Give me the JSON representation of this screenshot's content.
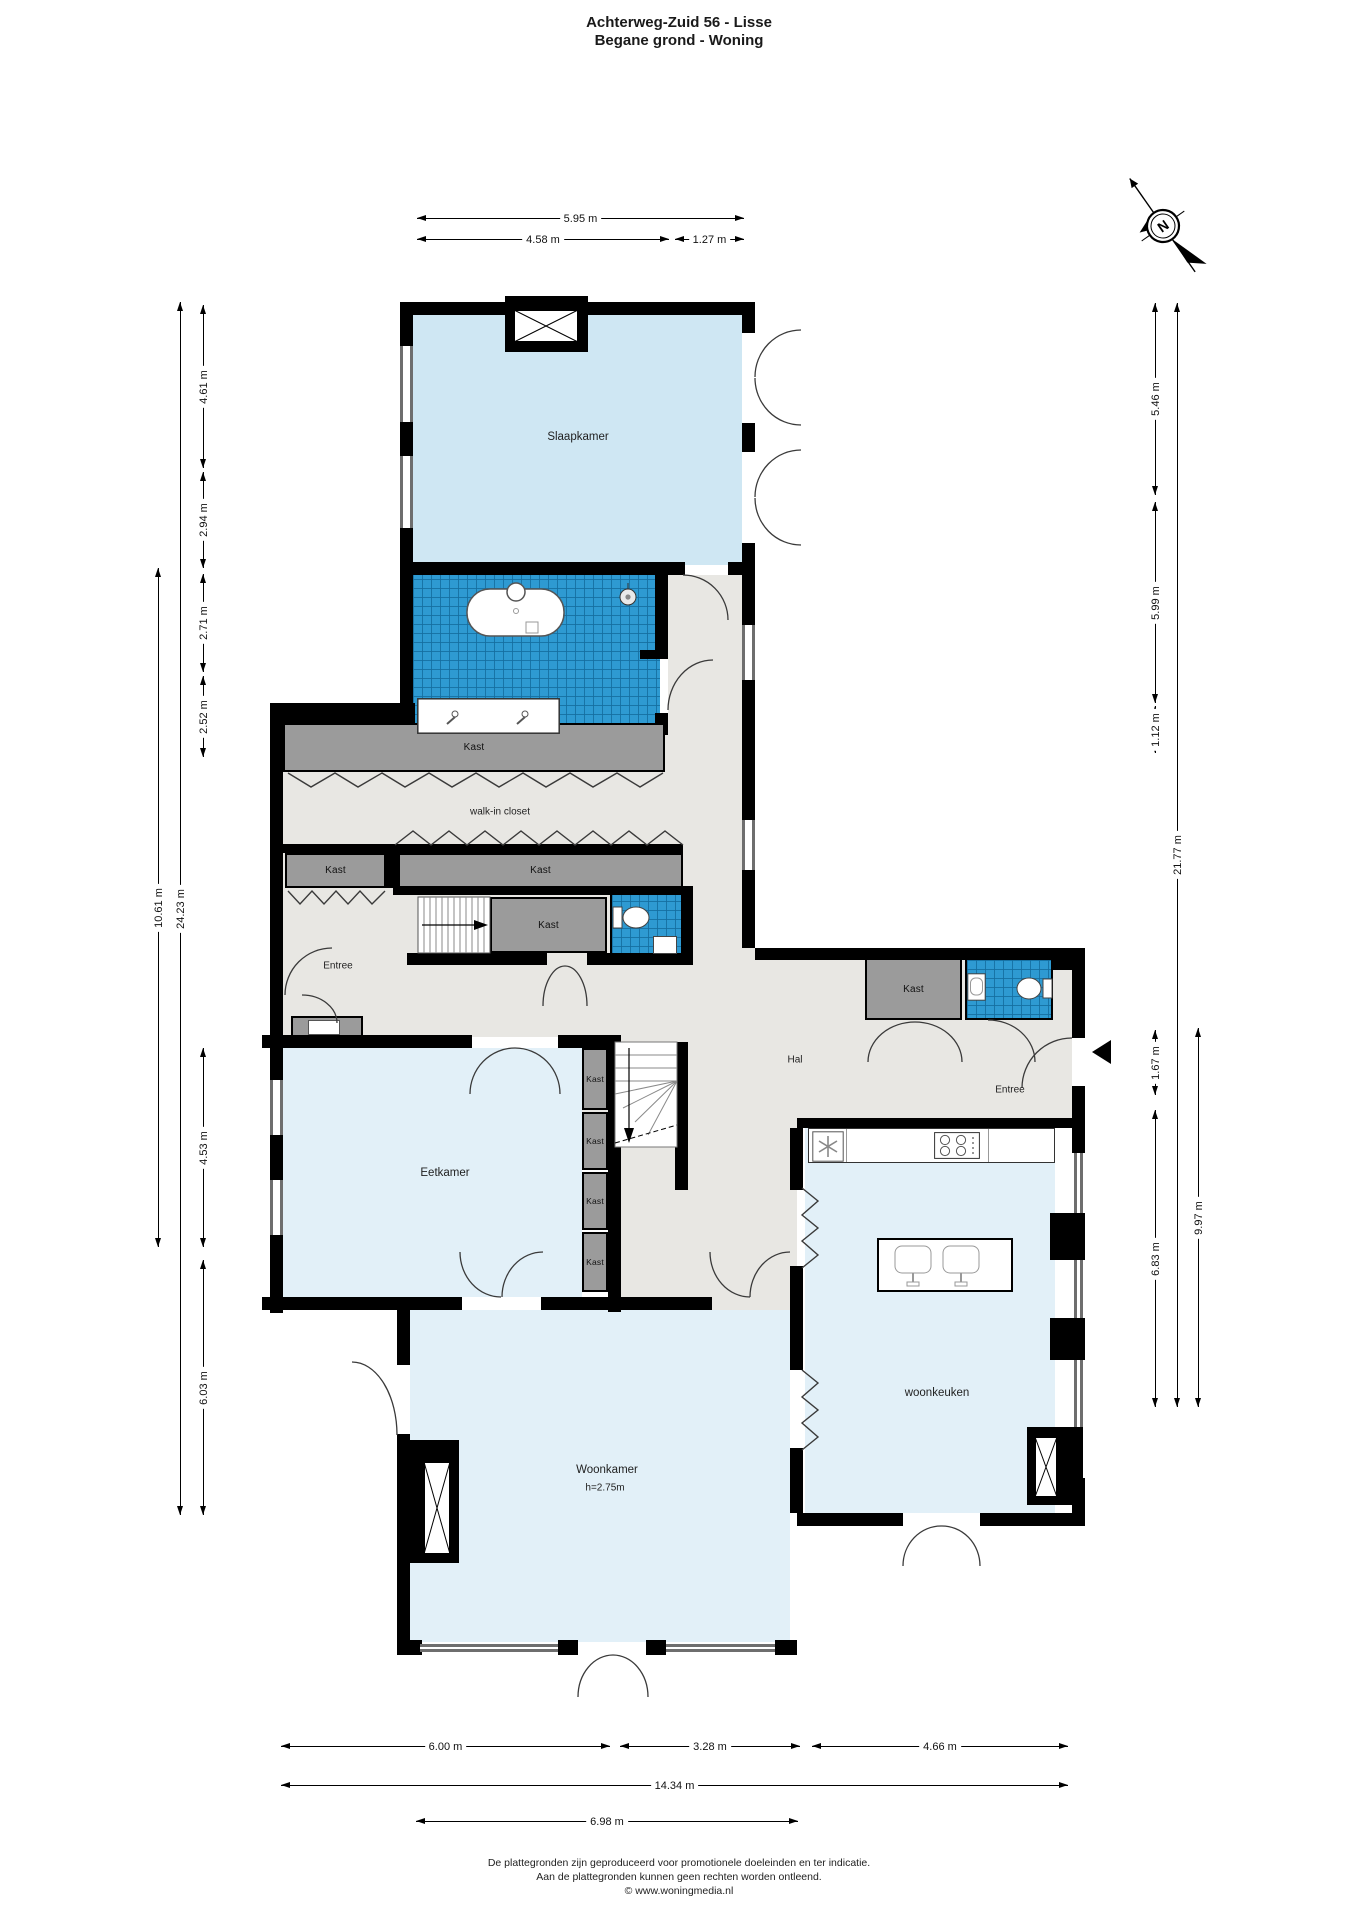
{
  "title": {
    "line1": "Achterweg-Zuid 56 - Lisse",
    "line2": "Begane grond - Woning"
  },
  "compass": {
    "label": "N"
  },
  "rooms": {
    "slaapkamer": "Slaapkamer",
    "kast": "Kast",
    "walk_in_closet": "walk-in closet",
    "entree": "Entree",
    "hal": "Hal",
    "eetkamer": "Eetkamer",
    "woonkamer": "Woonkamer",
    "woonkamer_height": "h=2.75m",
    "woonkeuken": "woonkeuken"
  },
  "dimensions": {
    "top": [
      "5.95 m",
      "4.58 m",
      "1.27 m"
    ],
    "left": [
      "4.61 m",
      "2.94 m",
      "2.71 m",
      "2.52 m",
      "4.53 m",
      "6.03 m",
      "24.23 m",
      "10.61 m"
    ],
    "right": [
      "5.46 m",
      "5.99 m",
      "1.12 m",
      "1.67 m",
      "6.83 m",
      "21.77 m",
      "9.97 m"
    ],
    "bottom": [
      "6.00 m",
      "3.28 m",
      "4.66 m",
      "14.34 m",
      "6.98 m"
    ]
  },
  "footer": {
    "line1": "De plattegronden zijn geproduceerd voor promotionele doeleinden en ter indicatie.",
    "line2": "Aan de plattegronden kunnen geen rechten worden ontleend.",
    "line3": "© www.woningmedia.nl"
  },
  "colors": {
    "wall": "#000000",
    "bedroom_floor": "#cfe7f3",
    "living_floor": "#e2f0f8",
    "hall_floor": "#e8e7e3",
    "bathroom_tile": "#2e9ad2",
    "tile_grid": "#1a7cb0",
    "closet_fill": "#9b9b9b"
  }
}
